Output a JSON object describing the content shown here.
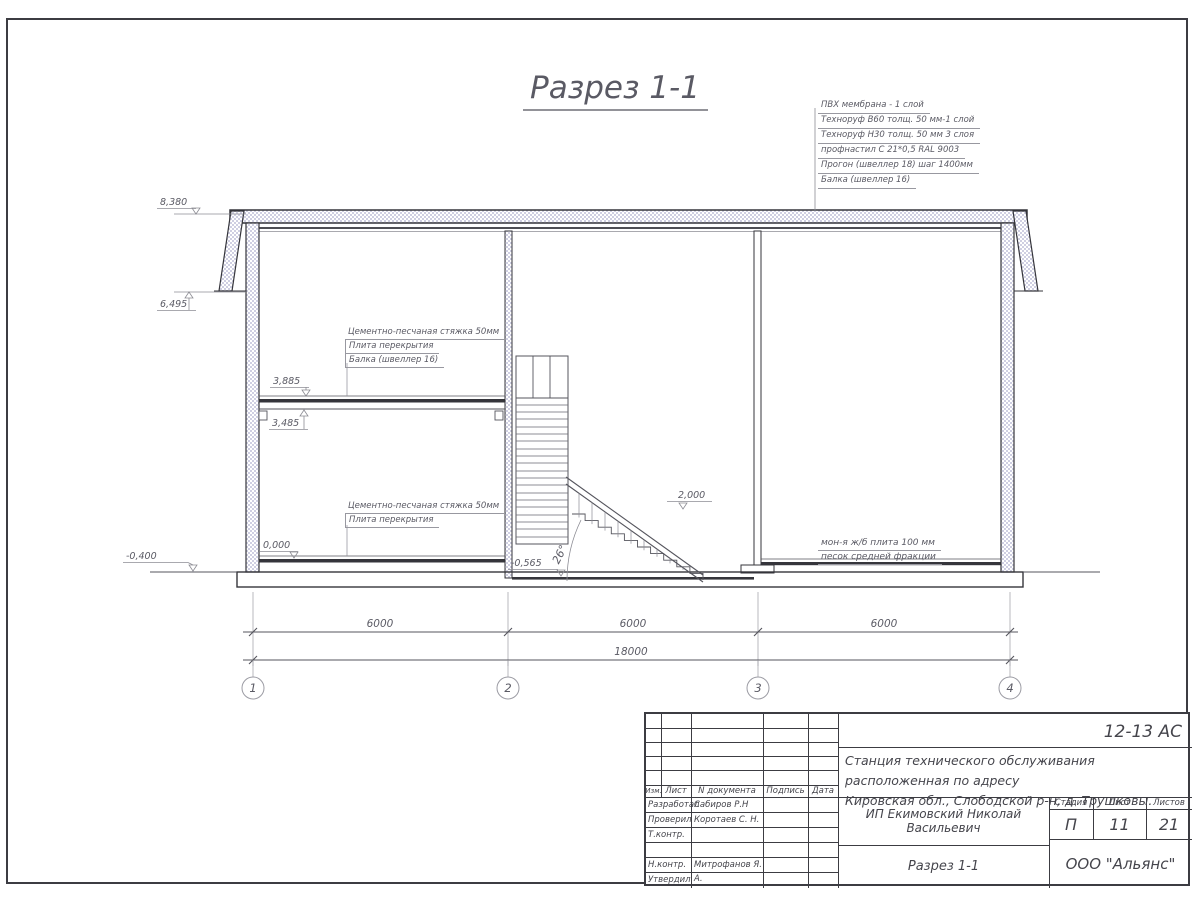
{
  "sheet": {
    "title": "Разрез 1-1"
  },
  "roof_spec": [
    "ПВХ мембрана - 1 слой",
    "Техноруф В60 толщ. 50 мм-1 слой",
    "Техноруф Н30 толщ. 50 мм 3 слоя",
    "профнастил С 21*0,5 RAL 9003",
    "Прогон (швеллер 18) шаг 1400мм",
    "Балка (швеллер 16)"
  ],
  "notes": {
    "floor2": [
      "Цементно-песчаная стяжка 50мм",
      "Плита перекрытия",
      "Балка (швеллер 16)"
    ],
    "floor1": [
      "Цементно-песчаная стяжка 50мм",
      "Плита перекрытия"
    ],
    "slab": [
      "мон-я ж/б плита 100 мм",
      "песок средней фракции"
    ]
  },
  "elevations": {
    "roof": "8,380",
    "eave": "6,495",
    "slab_top": "3,885",
    "slab_under": "3,485",
    "floor": "0,000",
    "ground": "-0,400",
    "landing": "2,000",
    "stair_base": "-0,565"
  },
  "stair": {
    "angle": "26°"
  },
  "dimensions": {
    "spans": [
      "6000",
      "6000",
      "6000"
    ],
    "total": "18000"
  },
  "axes": [
    "1",
    "2",
    "3",
    "4"
  ],
  "titleblock": {
    "code": "12-13 АС",
    "project_line1": "Станция технического обслуживания расположенная по адресу",
    "project_line2": "Кировская обл., Слободской р-н, д. Трушковы.",
    "client": "ИП Екимовский Николай Васильевич",
    "sheet_title": "Разрез 1-1",
    "company": "ООО \"Альянс\"",
    "headers": {
      "izm": "Изм.",
      "list": "Лист",
      "ndoc": "N документа",
      "podpis": "Подпись",
      "data": "Дата"
    },
    "stage_label": "Стадия",
    "sheet_label": "Лист",
    "sheets_label": "Листов",
    "stage": "П",
    "sheet_no": "11",
    "sheets_total": "21",
    "roles": [
      {
        "role": "Разработал",
        "name": "Сабиров Р.Н"
      },
      {
        "role": "Проверил",
        "name": "Коротаев С. Н."
      },
      {
        "role": "Т.контр.",
        "name": ""
      },
      {
        "role": "",
        "name": ""
      },
      {
        "role": "Н.контр.",
        "name": "Митрофанов Я. А."
      },
      {
        "role": "Утвердил",
        "name": ""
      }
    ]
  }
}
